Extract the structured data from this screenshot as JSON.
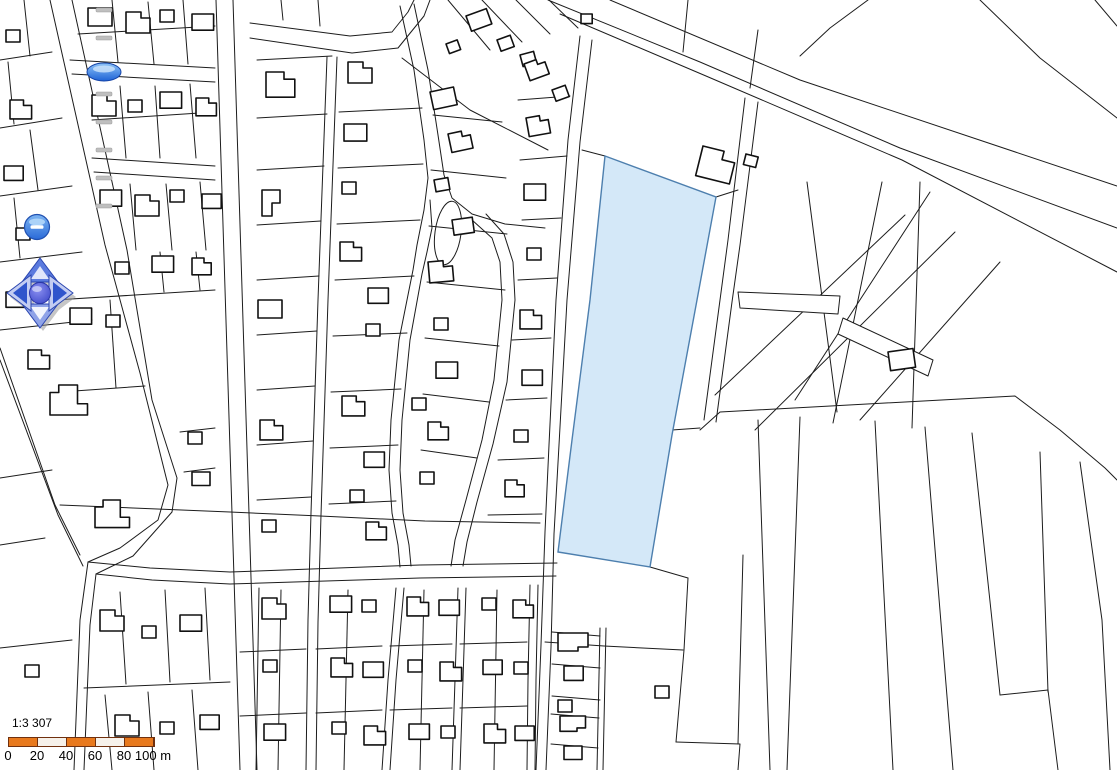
{
  "map": {
    "background": "#ffffff",
    "line_color": "#1c1c1c",
    "building_color": "#111111",
    "selected_parcel": {
      "points": "605,156 716,197 697,300 672,435 650,567 558,552 572,440 590,300",
      "fill": "#d4e8f8",
      "stroke": "#4d7fae"
    },
    "oval_island": {
      "cx": 448,
      "cy": 233,
      "rx": 13,
      "ry": 32,
      "rotate": 8
    },
    "thin_polygons": [
      "738,292 840,296 838,314 740,308",
      "843,318 933,360 928,376 838,334"
    ],
    "lines": [
      "50,0 105,245 140,373 168,485 158,520 120,548 88,562",
      "72,0 127,250 152,400 177,478 172,512 133,556 96,574",
      "0,348 55,505 80,555",
      "0,360 58,515 83,566",
      "88,562 80,620 74,770",
      "96,574 90,625 84,770",
      "88,562 150,568 230,572 420,565 557,563",
      "96,574 152,580 230,584 420,578 556,576",
      "216,0 240,770",
      "233,0 257,770",
      "250,23 350,36 392,32 408,12 414,0",
      "250,38 352,53 398,48 424,16 430,0",
      "414,4 428,70 438,135 444,175 452,198 472,214 505,224 545,228",
      "400,6 414,70 424,140 428,178 424,210 417,245 413,270 399,340 391,420 389,470 392,513 398,545 400,567",
      "430,200 432,228 427,252 422,274 410,340 402,420 400,470 403,513 409,545 411,566",
      "472,220 492,238 500,262 502,300 494,380 482,440 466,500 455,540 451,566",
      "486,214 504,234 513,262 515,300 507,382 493,444 477,502 467,542 463,566",
      "580,36 568,140 556,300 549,445 545,532 541,645 536,770",
      "592,40 580,142 567,300 559,445 554,534 551,647 546,770",
      "327,57 318,300 311,513 308,620 306,770",
      "337,57 328,300 321,515 318,622 316,770",
      "530,585 528,680 527,770",
      "538,585 536,680 535,770",
      "396,588 388,680 382,770",
      "404,588 396,680 390,770",
      "458,588 455,680 452,770",
      "466,588 463,680 460,770",
      "548,0 700,62 900,148 1117,228",
      "560,14 706,76 902,160 1117,272",
      "610,0 800,80 1117,186",
      "70,60 215,68",
      "72,74 215,82",
      "92,158 215,166",
      "94,172 215,180",
      "0,60 52,52",
      "0,128 62,118",
      "0,196 72,186",
      "0,262 82,252",
      "0,330 92,320",
      "24,0 30,56",
      "8,62 14,124",
      "30,130 38,190",
      "14,198 20,258",
      "36,264 44,322",
      "78,34 215,26",
      "112,0 118,62",
      "148,2 154,64",
      "183,0 188,64",
      "120,86 126,158",
      "155,86 160,158",
      "190,84 196,158",
      "92,120 215,112",
      "130,184 136,250",
      "166,184 172,250",
      "200,182 206,250",
      "55,300 215,290",
      "110,300 116,388",
      "60,392 145,386",
      "0,478 52,470",
      "160,252 164,292",
      "196,252 200,290",
      "0,545 45,538",
      "0,648 72,640",
      "84,688 230,682",
      "120,592 126,684",
      "165,590 170,682",
      "205,588 210,680",
      "105,695 112,770",
      "148,692 154,770",
      "192,690 198,770",
      "180,432 215,428",
      "184,472 215,468",
      "257,60 332,56",
      "257,118 327,114",
      "257,170 324,166",
      "257,225 321,221",
      "257,280 319,276",
      "257,335 317,331",
      "257,390 315,386",
      "257,445 313,441",
      "257,500 311,497",
      "339,112 422,108",
      "338,168 423,164",
      "337,224 420,220",
      "335,280 414,276",
      "333,336 407,333",
      "331,392 401,389",
      "330,448 398,445",
      "329,504 396,501",
      "433,115 502,122",
      "431,170 506,178",
      "429,226 507,234",
      "427,282 505,290",
      "425,338 499,346",
      "423,394 489,402",
      "421,450 477,458",
      "448,0 490,50",
      "482,0 522,42",
      "516,0 550,34",
      "549,0 578,28",
      "402,58 470,110 548,150",
      "518,100 570,96",
      "520,160 567,156",
      "522,220 561,218",
      "518,280 557,278",
      "512,340 551,338",
      "506,400 547,398",
      "498,460 544,458",
      "488,515 542,514",
      "60,505 230,512 320,516 425,521 540,523",
      "281,0 283,20",
      "318,0 320,26",
      "259,588 256,770",
      "281,590 278,770",
      "348,590 344,770",
      "424,590 420,770",
      "497,590 494,770",
      "240,652 306,649",
      "316,649 382,646",
      "390,646 452,644",
      "460,644 527,642",
      "240,716 306,713",
      "316,713 382,710",
      "390,710 452,708",
      "460,708 527,706",
      "552,632 600,636",
      "552,664 600,668",
      "552,696 600,700",
      "551,714 599,718",
      "551,744 598,748",
      "600,628 597,770",
      "606,628 603,770",
      "605,156 582,150",
      "716,197 738,190",
      "650,567 688,578",
      "688,578 684,650 676,742",
      "545,642 604,646 683,650",
      "676,742 740,744 738,770",
      "743,555 738,744",
      "672,430 700,428",
      "745,98 728,240 720,300 704,420",
      "758,102 740,245 732,302 716,422",
      "807,182 837,412",
      "882,182 833,423",
      "930,192 795,400",
      "905,215 715,395",
      "955,232 755,430",
      "920,182 912,428",
      "1000,262 860,420",
      "700,430 720,412 1015,396 1060,430 1105,468 1117,480",
      "868,0 830,28 800,56",
      "980,0 1040,58 1117,118",
      "1095,0 1117,26",
      "688,0 683,52",
      "758,30 750,88",
      "758,420 770,770",
      "800,417 787,770",
      "875,421 893,770",
      "925,427 953,770",
      "972,433 1000,695",
      "1040,452 1048,692",
      "1000,695 1048,690",
      "1048,690 1058,770",
      "1080,462 1102,620 1110,770"
    ],
    "building_templates": [
      "0,0 24,0 24,18 0,18",
      "0,0 15,0 15,6 24,6 24,21 0,21",
      "0,0 18,0 18,13 10,13 10,26 0,26",
      "0,6 7,6 7,0 22,0 22,15 30,15 30,24 0,24",
      "0,0 14,0 14,12 0,12",
      "0,0 30,0 30,14 20,14 20,18 0,18"
    ],
    "buildings": [
      [
        0,
        88,
        8,
        0,
        1
      ],
      [
        1,
        126,
        12,
        0,
        1
      ],
      [
        4,
        160,
        10,
        0,
        1
      ],
      [
        0,
        192,
        14,
        0,
        0.9
      ],
      [
        1,
        92,
        95,
        0,
        1
      ],
      [
        4,
        128,
        100,
        0,
        1
      ],
      [
        0,
        160,
        92,
        0,
        0.9
      ],
      [
        1,
        196,
        98,
        0,
        0.85
      ],
      [
        0,
        100,
        190,
        0,
        0.9
      ],
      [
        1,
        135,
        195,
        0,
        1
      ],
      [
        4,
        170,
        190,
        0,
        1
      ],
      [
        0,
        202,
        194,
        0,
        0.8
      ],
      [
        4,
        6,
        30,
        0,
        1
      ],
      [
        1,
        10,
        100,
        0,
        0.9
      ],
      [
        0,
        4,
        166,
        0,
        0.8
      ],
      [
        4,
        16,
        228,
        0,
        1
      ],
      [
        0,
        6,
        292,
        0,
        0.85
      ],
      [
        4,
        115,
        262,
        0,
        1
      ],
      [
        0,
        152,
        256,
        0,
        0.9
      ],
      [
        1,
        192,
        258,
        0,
        0.8
      ],
      [
        0,
        70,
        308,
        0,
        0.9
      ],
      [
        4,
        106,
        315,
        0,
        1
      ],
      [
        1,
        28,
        350,
        0,
        0.9
      ],
      [
        3,
        50,
        385,
        0,
        1.25
      ],
      [
        3,
        95,
        500,
        0,
        1.15
      ],
      [
        4,
        188,
        432,
        0,
        1
      ],
      [
        0,
        192,
        472,
        0,
        0.75
      ],
      [
        1,
        100,
        610,
        0,
        1
      ],
      [
        4,
        142,
        626,
        0,
        1
      ],
      [
        0,
        180,
        615,
        0,
        0.9
      ],
      [
        4,
        25,
        665,
        0,
        1
      ],
      [
        1,
        115,
        715,
        0,
        1
      ],
      [
        4,
        160,
        722,
        0,
        1
      ],
      [
        0,
        200,
        715,
        0,
        0.8
      ],
      [
        1,
        266,
        72,
        0,
        1.2
      ],
      [
        2,
        262,
        190,
        0,
        1
      ],
      [
        0,
        258,
        300,
        0,
        1
      ],
      [
        1,
        260,
        420,
        0,
        0.95
      ],
      [
        4,
        262,
        520,
        0,
        1
      ],
      [
        1,
        348,
        62,
        0,
        1
      ],
      [
        0,
        344,
        124,
        0,
        0.95
      ],
      [
        4,
        342,
        182,
        0,
        1
      ],
      [
        1,
        340,
        242,
        0,
        0.9
      ],
      [
        0,
        368,
        288,
        0,
        0.85
      ],
      [
        4,
        366,
        324,
        0,
        1
      ],
      [
        1,
        342,
        396,
        0,
        0.95
      ],
      [
        0,
        364,
        452,
        0,
        0.85
      ],
      [
        4,
        350,
        490,
        0,
        1
      ],
      [
        1,
        366,
        522,
        0,
        0.85
      ],
      [
        0,
        430,
        92,
        -12,
        1
      ],
      [
        1,
        448,
        134,
        -12,
        0.9
      ],
      [
        4,
        434,
        180,
        -10,
        1
      ],
      [
        0,
        452,
        220,
        -8,
        0.85
      ],
      [
        1,
        428,
        262,
        -5,
        1
      ],
      [
        4,
        434,
        318,
        0,
        1
      ],
      [
        0,
        436,
        362,
        0,
        0.9
      ],
      [
        4,
        412,
        398,
        0,
        1
      ],
      [
        1,
        428,
        422,
        0,
        0.85
      ],
      [
        4,
        420,
        472,
        0,
        1
      ],
      [
        4,
        520,
        55,
        -15,
        1
      ],
      [
        1,
        526,
        118,
        -10,
        0.9
      ],
      [
        0,
        524,
        184,
        0,
        0.9
      ],
      [
        4,
        527,
        248,
        0,
        1
      ],
      [
        1,
        520,
        310,
        0,
        0.9
      ],
      [
        0,
        522,
        370,
        0,
        0.85
      ],
      [
        4,
        514,
        430,
        0,
        1
      ],
      [
        1,
        505,
        480,
        0,
        0.8
      ],
      [
        0,
        466,
        16,
        -20,
        0.9
      ],
      [
        4,
        497,
        40,
        -20,
        1
      ],
      [
        1,
        524,
        64,
        -20,
        0.85
      ],
      [
        4,
        552,
        90,
        -20,
        1
      ],
      [
        4,
        446,
        44,
        -20,
        0.85
      ],
      [
        4,
        581,
        14,
        0,
        0.8
      ],
      [
        1,
        262,
        598,
        0,
        1
      ],
      [
        0,
        330,
        596,
        0,
        0.9
      ],
      [
        4,
        362,
        600,
        0,
        1
      ],
      [
        1,
        407,
        597,
        0,
        0.9
      ],
      [
        0,
        439,
        600,
        0,
        0.85
      ],
      [
        4,
        482,
        598,
        0,
        1
      ],
      [
        1,
        513,
        600,
        0,
        0.85
      ],
      [
        4,
        263,
        660,
        0,
        1
      ],
      [
        1,
        331,
        658,
        0,
        0.9
      ],
      [
        0,
        363,
        662,
        0,
        0.85
      ],
      [
        4,
        408,
        660,
        0,
        1
      ],
      [
        1,
        440,
        662,
        0,
        0.9
      ],
      [
        0,
        483,
        660,
        0,
        0.8
      ],
      [
        4,
        514,
        662,
        0,
        1
      ],
      [
        0,
        264,
        724,
        0,
        0.9
      ],
      [
        4,
        332,
        722,
        0,
        1
      ],
      [
        1,
        364,
        726,
        0,
        0.9
      ],
      [
        0,
        409,
        724,
        0,
        0.85
      ],
      [
        4,
        441,
        726,
        0,
        1
      ],
      [
        1,
        484,
        724,
        0,
        0.9
      ],
      [
        0,
        515,
        726,
        0,
        0.8
      ],
      [
        5,
        558,
        633,
        0,
        1
      ],
      [
        0,
        564,
        666,
        0,
        0.8
      ],
      [
        4,
        558,
        700,
        0,
        1
      ],
      [
        5,
        560,
        716,
        0,
        0.85
      ],
      [
        0,
        564,
        746,
        0,
        0.75
      ],
      [
        0,
        888,
        352,
        -8,
        1.05
      ],
      [
        4,
        655,
        686,
        0,
        1
      ],
      [
        1,
        703,
        146,
        14,
        1.45
      ],
      [
        4,
        746,
        154,
        14,
        0.9
      ]
    ]
  },
  "controls": {
    "zoom_slider": {
      "tick_count": 8,
      "tick_start_y": 8,
      "tick_gap": 28,
      "center_x": 104,
      "handle_y": 72
    },
    "zoom_out_button": {
      "glyph": "−",
      "cx": 37,
      "cy": 227
    },
    "pan_control": {
      "center_x": 40,
      "center_y": 293,
      "buttons": [
        "pan-up",
        "pan-right",
        "pan-down",
        "pan-left",
        "pan-center"
      ]
    },
    "colors": {
      "button_top": "#7db5f2",
      "button_bottom": "#2a6ad8",
      "button_rim": "#2050b0",
      "arrow_light": "#c3cdf2",
      "arrow_mid": "#5a7ade",
      "arrow_dark": "#2f55cc",
      "knob_top": "#8a8ff0",
      "knob_bottom": "#3c47c8",
      "tick": "#bfbfbf"
    }
  },
  "scale_bar": {
    "ratio_label": "1:3 307",
    "tick_labels": [
      "0",
      "20",
      "40",
      "60",
      "80",
      "100 m"
    ],
    "segment_fills": [
      "#E8791D",
      "#F6F1EA",
      "#E8791D",
      "#F6F1EA",
      "#E8791D"
    ],
    "border_color": "#70300E",
    "x": 8,
    "y": 25,
    "width": 145,
    "height": 8
  }
}
